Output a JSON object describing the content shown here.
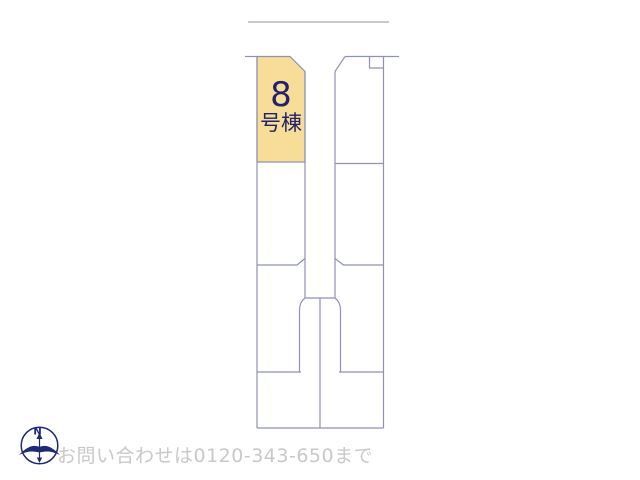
{
  "map": {
    "highlighted_lot": {
      "number": "8",
      "suffix": "号棟"
    }
  },
  "compass": {
    "label": "N"
  },
  "footer": {
    "contact": "お問い合わせは0120-343-650まで"
  },
  "colors": {
    "highlight_fill": "#f8dd98",
    "line": "#8f92b2",
    "road_line": "#8d93a8",
    "lot_label": "#22226a",
    "contact_text": "#c9c9c9",
    "compass": "#1e2a72",
    "background": "#ffffff"
  }
}
